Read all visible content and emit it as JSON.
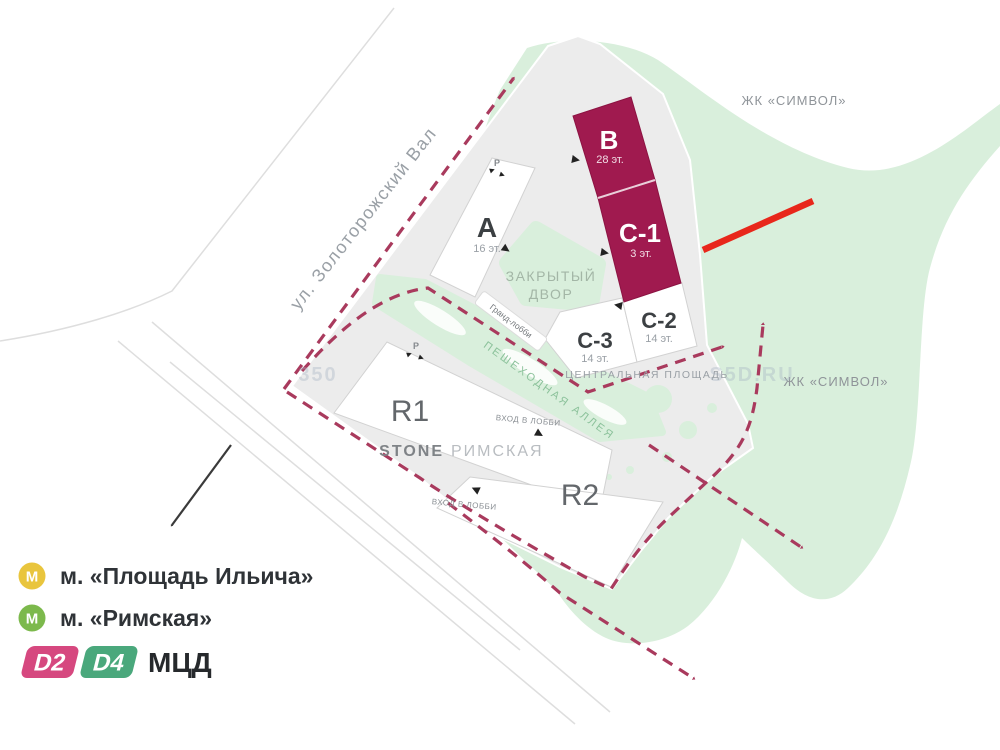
{
  "colors": {
    "building_highlight": "#a01a4f",
    "building_highlight_dark": "#8c1342",
    "site": "#ececec",
    "green": "#d9efdc",
    "route_dashed": "#a93a5d",
    "annotation_red": "#e8271b",
    "metro_yellow": "#e9c53d",
    "metro_green": "#7cb94c",
    "mcd_d2": "#d6487f",
    "mcd_d4": "#4aa87c"
  },
  "map": {
    "street_label": "ул. Золоторожский Вал",
    "neighbor_top": "ЖК «СИМВОЛ»",
    "neighbor_right": "ЖК «СИМВОЛ»",
    "watermark_left": "350",
    "watermark_right": "S5D.RU",
    "buildings": {
      "a": {
        "name": "А",
        "floors": "16 эт."
      },
      "b": {
        "name": "В",
        "floors": "28 эт."
      },
      "c1": {
        "name": "С-1",
        "floors": "3 эт."
      },
      "c2": {
        "name": "С-2",
        "floors": "14 эт."
      },
      "c3": {
        "name": "С-3",
        "floors": "14 эт."
      },
      "r1": {
        "name": "R1"
      },
      "r2": {
        "name": "R2"
      }
    },
    "labels": {
      "courtyard_line1": "ЗАКРЫТЫЙ",
      "courtyard_line2": "ДВОР",
      "grand_lobby": "Гранд-лобби",
      "alley": "ПЕШЕХОДНАЯ АЛЛЕЯ",
      "central_square": "ЦЕНТРАЛЬНАЯ ПЛОЩАДЬ",
      "lobby_entrance_r1": "ВХОД В ЛОББИ",
      "lobby_entrance_r2": "ВХОД В ЛОББИ",
      "parking_a": "P",
      "parking_r1": "P",
      "brand": "STONE",
      "brand_project": "РИМСКАЯ"
    }
  },
  "legend": {
    "metro1": {
      "icon": "М",
      "label": "м. «Площадь Ильича»"
    },
    "metro2": {
      "icon": "М",
      "label": "м. «Римская»"
    },
    "mcd": {
      "d2": "D2",
      "d4": "D4",
      "label": "МЦД"
    }
  }
}
